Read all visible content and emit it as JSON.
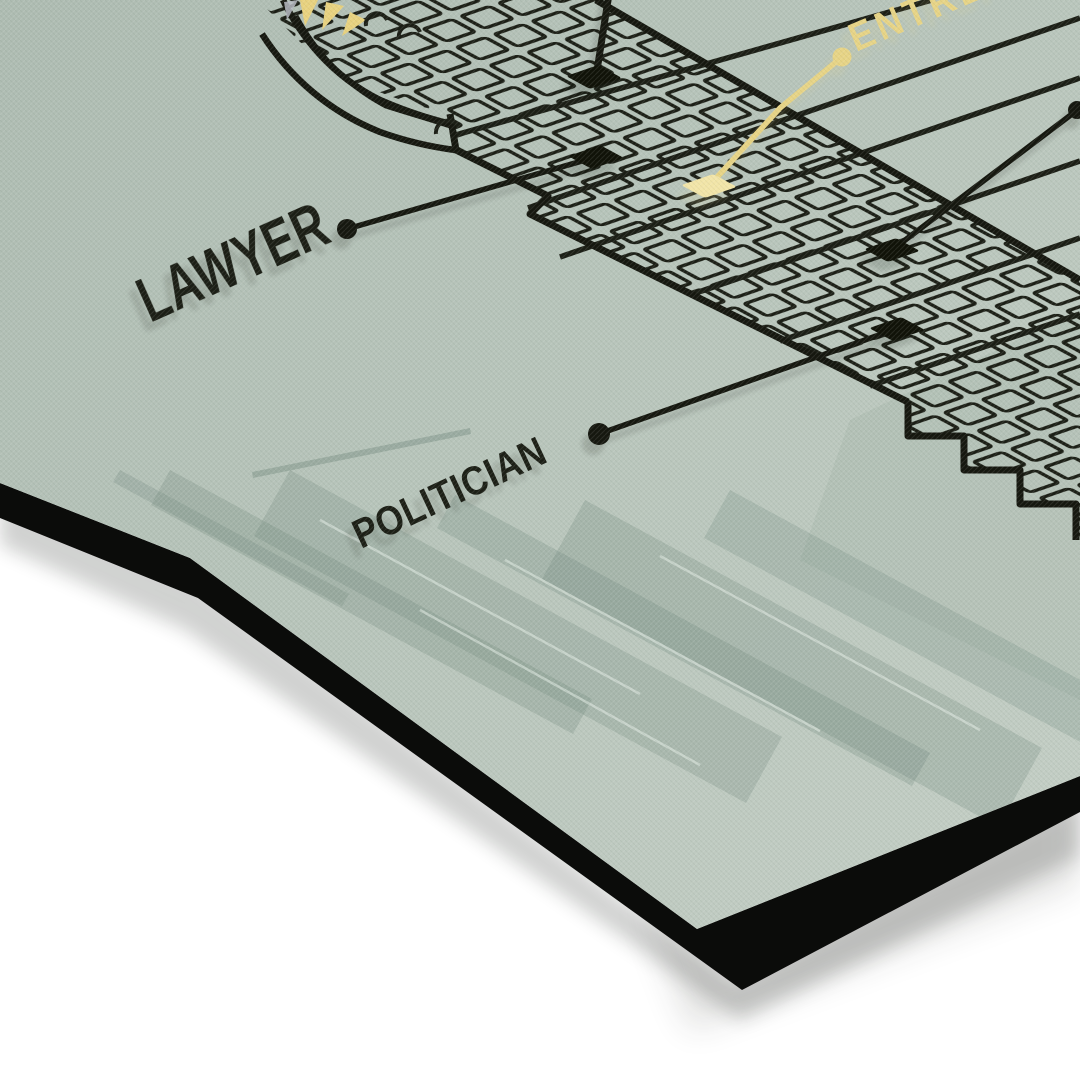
{
  "scene": {
    "type": "product photo of a tilted mounted art print on a white surface",
    "background_color": "#ffffff",
    "poster_background": "#b7c4ba",
    "ink_color": "#1b1e15",
    "gold_accent": "#e7d486",
    "panel_edge_color": "#0b0c0a"
  },
  "poster": {
    "artwork": "skyscraper facade blueprint line drawing with arched crown, gold sunburst detail, window grid, callout leader lines and a ghosted faded building base",
    "labels": {
      "lawyer": "LAWYER",
      "politician": "POLITICIAN",
      "entrepreneur": "ENTREPRENEUR"
    },
    "highlight_label": "ENTREPRENEUR",
    "callouts": [
      {
        "label": "LAWYER",
        "style": "black-leader-dot"
      },
      {
        "label": "POLITICIAN",
        "style": "black-leader-dot"
      },
      {
        "label": "ENTREPRENEUR",
        "style": "gold-leader-dot",
        "visibility": "label cropped at top-right corner"
      },
      {
        "label": "",
        "style": "black-leader",
        "visibility": "leader cropped at top edge"
      },
      {
        "label": "",
        "style": "black-leader-dot",
        "visibility": "leader cropped at right edge"
      }
    ]
  }
}
